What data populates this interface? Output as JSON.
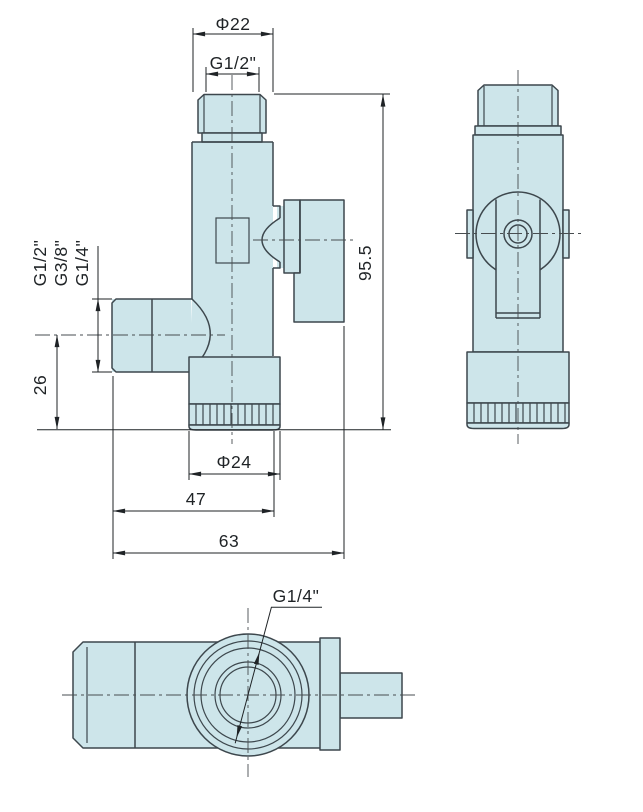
{
  "drawing": {
    "type": "valve-orthographic-views",
    "front_view": {
      "dim_top_diameter": "Φ22",
      "dim_top_thread": "G1/2\"",
      "outlet_thread_options": [
        "G1/2\"",
        "G3/8\"",
        "G1/4\""
      ],
      "dim_outlet_center_height": "26",
      "dim_overall_height": "95.5",
      "dim_base_diameter": "Φ24",
      "dim_body_width": "47",
      "dim_overall_width": "63"
    },
    "bottom_view": {
      "dim_side_port_thread": "G1/4\""
    },
    "colors": {
      "body_fill": "#cde5ea",
      "outline": "#3d474d",
      "dim": "#1f2326",
      "centerline": "#474d50",
      "page_bg": "#ffffff"
    }
  }
}
